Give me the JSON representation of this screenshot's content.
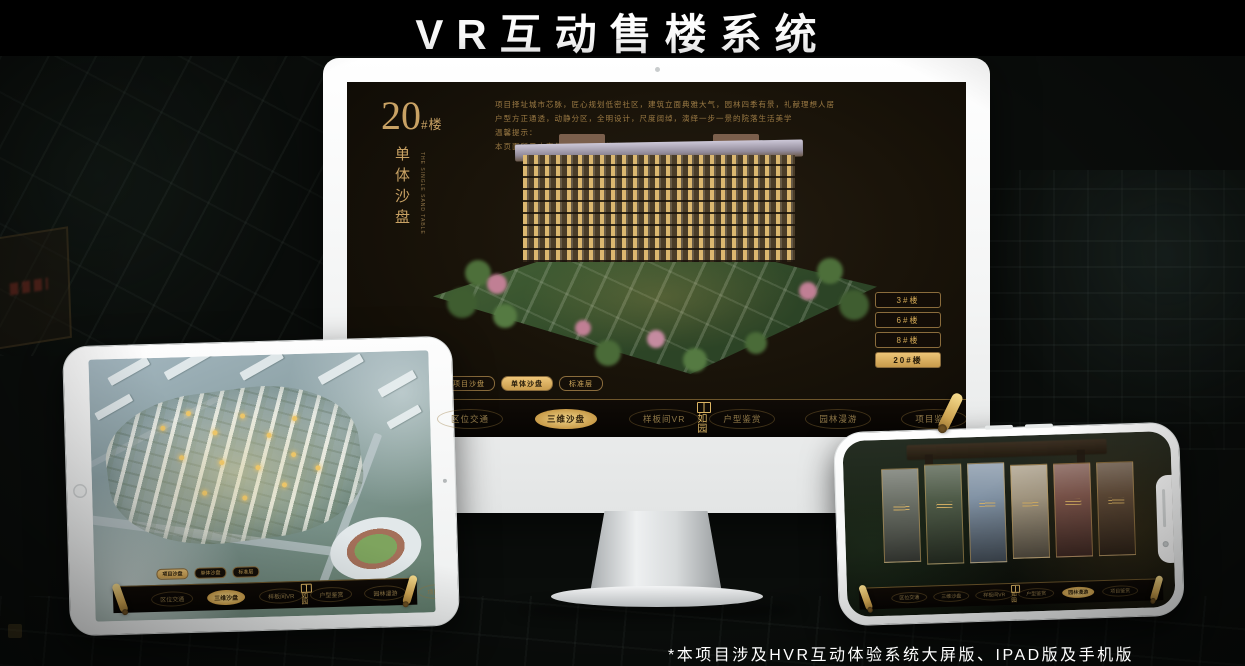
{
  "page": {
    "title": "VR互动售楼系统",
    "footnote": "*本项目涉及HVR互动体验系统大屏版、IPAD版及手机版"
  },
  "colors": {
    "gold": "#d2a855",
    "gold_bright": "#eec679",
    "screen_bg": "#17110a",
    "monitor_body": "#f3f4f4"
  },
  "desktop": {
    "building_no": "20",
    "building_no_suffix": "#楼",
    "title_vertical": "单体沙盘",
    "title_en": "THE SINGLE SAND TABLE",
    "description_lines": [
      "项目择址城市芯脉，匠心规划低密社区，建筑立面典雅大气，园林四季有景，礼献理想人居",
      "户型方正通透，动静分区，全明设计，尺度阔绰，演绎一步一景的院落生活美学",
      "温馨提示：",
      "本页面所示内容仅供参考，具体信息以项目实际交付为准"
    ],
    "floor_buttons": [
      {
        "label": "3#楼"
      },
      {
        "label": "6#楼"
      },
      {
        "label": "8#楼"
      },
      {
        "label": "20#楼",
        "selected": true
      }
    ],
    "sub_tabs": [
      {
        "label": "项目沙盘"
      },
      {
        "label": "单体沙盘",
        "selected": true
      },
      {
        "label": "标准层"
      }
    ],
    "nav": {
      "logo": "如园",
      "left": [
        {
          "label": "区位交通"
        },
        {
          "label": "三维沙盘",
          "selected": true
        },
        {
          "label": "样板间VR"
        }
      ],
      "right": [
        {
          "label": "户型鉴赏"
        },
        {
          "label": "园林漫游"
        },
        {
          "label": "项目鉴赏"
        }
      ]
    }
  },
  "tablet": {
    "sub_tabs": [
      {
        "label": "项目沙盘",
        "selected": true
      },
      {
        "label": "单体沙盘"
      },
      {
        "label": "标准层"
      }
    ],
    "nav": {
      "logo": "如园",
      "left": [
        {
          "label": "区位交通"
        },
        {
          "label": "三维沙盘",
          "selected": true
        },
        {
          "label": "样板间VR"
        }
      ],
      "right": [
        {
          "label": "户型鉴赏"
        },
        {
          "label": "园林漫游"
        },
        {
          "label": "项目鉴赏"
        }
      ]
    }
  },
  "phone": {
    "gallery": [
      {
        "color": "#63685e"
      },
      {
        "color": "#45523e"
      },
      {
        "color": "#7b8da0"
      },
      {
        "color": "#a3967e"
      },
      {
        "color": "#7a4f44"
      },
      {
        "color": "#5c4530"
      }
    ],
    "nav": {
      "logo": "如园",
      "left": [
        {
          "label": "区位交通"
        },
        {
          "label": "三维沙盘"
        },
        {
          "label": "样板间VR"
        }
      ],
      "right": [
        {
          "label": "户型鉴赏"
        },
        {
          "label": "园林漫游",
          "selected": true
        },
        {
          "label": "项目鉴赏"
        }
      ]
    }
  }
}
